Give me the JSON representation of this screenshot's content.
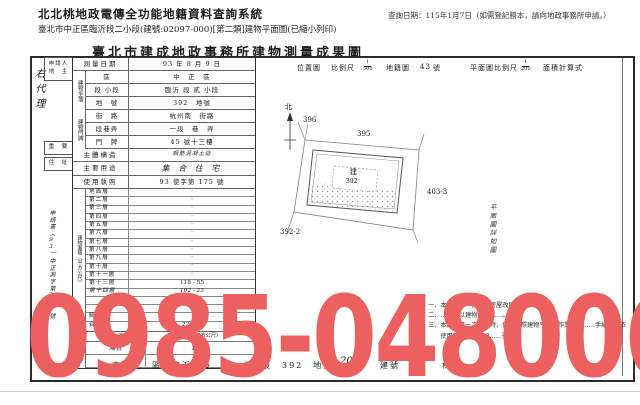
{
  "header": {
    "system_title": "北北桃地政電傳全功能地籍資料查詢系統",
    "query_date": "查詢日期：115年1月7日（如需登記謄本，請向地政事務所申請。）",
    "subtitle": "臺北市中正區臨沂段二小段(建號:02097-000)[第二類]建物平面圖(已縮小列印)"
  },
  "doc": {
    "title": "臺北市建成地政事務所建物測量成果圖",
    "margin_note": "右代理",
    "side": {
      "applicant_line1": "申請人",
      "applicant_line2": "地　主",
      "important": "重　要",
      "address": "住　址",
      "application_no": "申請書（93）中正測字第257號"
    },
    "fields": {
      "survey_date_label": "測量日期",
      "survey_date_value": "93 年 8 月 9 日",
      "location_group": "建物坐落",
      "district_label": "區",
      "district_value": "中　正　區",
      "section_label": "段 小段",
      "section_value": "臨沂 段 貳 小段",
      "parcel_label": "地　號",
      "parcel_value": "392　地號",
      "doorplate_group": "建物門牌",
      "street_label": "街　路",
      "street_value": "杭州南　街路",
      "lane_label": "段巷弄",
      "lane_value": "一段　巷　弄",
      "number_label": "門　牌",
      "number_value": "45 號十三樓",
      "structure_label": "主體構造",
      "structure_value": "鋼筋混凝土造",
      "use_label": "主要用途",
      "use_value": "集 合 住 宅",
      "license_label": "使用執照",
      "license_value": "93 使字第 175 號"
    },
    "area_section": {
      "group_label": "建物面積（平方公尺）",
      "floors": [
        {
          "label": "地面層",
          "value": "·",
          "hand": false
        },
        {
          "label": "第二層",
          "value": "·",
          "hand": false
        },
        {
          "label": "第三層",
          "value": "·",
          "hand": false
        },
        {
          "label": "第四層",
          "value": "·",
          "hand": false
        },
        {
          "label": "第五層",
          "value": "·",
          "hand": false
        },
        {
          "label": "第六層",
          "value": "·",
          "hand": false
        },
        {
          "label": "第七層",
          "value": "·",
          "hand": false
        },
        {
          "label": "第八層",
          "value": "·",
          "hand": false
        },
        {
          "label": "第九層",
          "value": "·",
          "hand": false
        },
        {
          "label": "第十層",
          "value": "·",
          "hand": false
        },
        {
          "label": "第十一層",
          "value": "·",
          "hand": false
        },
        {
          "label": "第十三層",
          "value": "118 - 55",
          "hand": false
        },
        {
          "label": "第十四層",
          "value": "102 - 25",
          "hand": true
        },
        {
          "label": "",
          "value": "·",
          "hand": false
        },
        {
          "label": "",
          "value": "·",
          "hand": false
        },
        {
          "label": "騎　樓",
          "value": "·",
          "hand": false
        }
      ],
      "total_label": "合　計",
      "total_value": "220·80"
    },
    "attachment_section": {
      "group_label": "附屬建物",
      "use_header": "用　途",
      "area_header": "面積（平方公尺）",
      "rows": [
        {
          "use": "陽台",
          "area": "10·08"
        },
        {
          "use": "",
          "area": "2·25"
        }
      ]
    },
    "map": {
      "location_label": "位置圖",
      "scale_label": "比例尺",
      "scale_num": "1",
      "scale_den": "500",
      "sheet_label": "地籍圖",
      "sheet_no": "43",
      "sheet_unit": "號",
      "plan_scale_label": "平面圖比例尺",
      "plan_num": "1",
      "plan_den": "200",
      "calc_label": "面積計算式",
      "north_label": "北",
      "parcels": {
        "p1": "396",
        "p2": "395",
        "p3": "403-3",
        "p4": "392-2",
        "center_tag": "建",
        "center_no": "392"
      },
      "side_note": "平面圖詳如圖"
    },
    "notes": [
      "一、本建物係　拆除　房屋改建……部分。",
      "二、……係以建物登記……。",
      "三、本建物第一次登記時，位置參照建物平面圖作業，本……手續……依",
      "　　使用（7F）……3……號。"
    ],
    "footer": {
      "parts": [
        "中",
        "正",
        "區",
        "臨沂",
        "段",
        "二",
        "小",
        "段",
        "392",
        "地號"
      ],
      "build_no": "2097",
      "build_label": "建號",
      "unit_label": "棟"
    }
  },
  "watermark": {
    "text": "0985-048006",
    "color": "#ec615f"
  }
}
